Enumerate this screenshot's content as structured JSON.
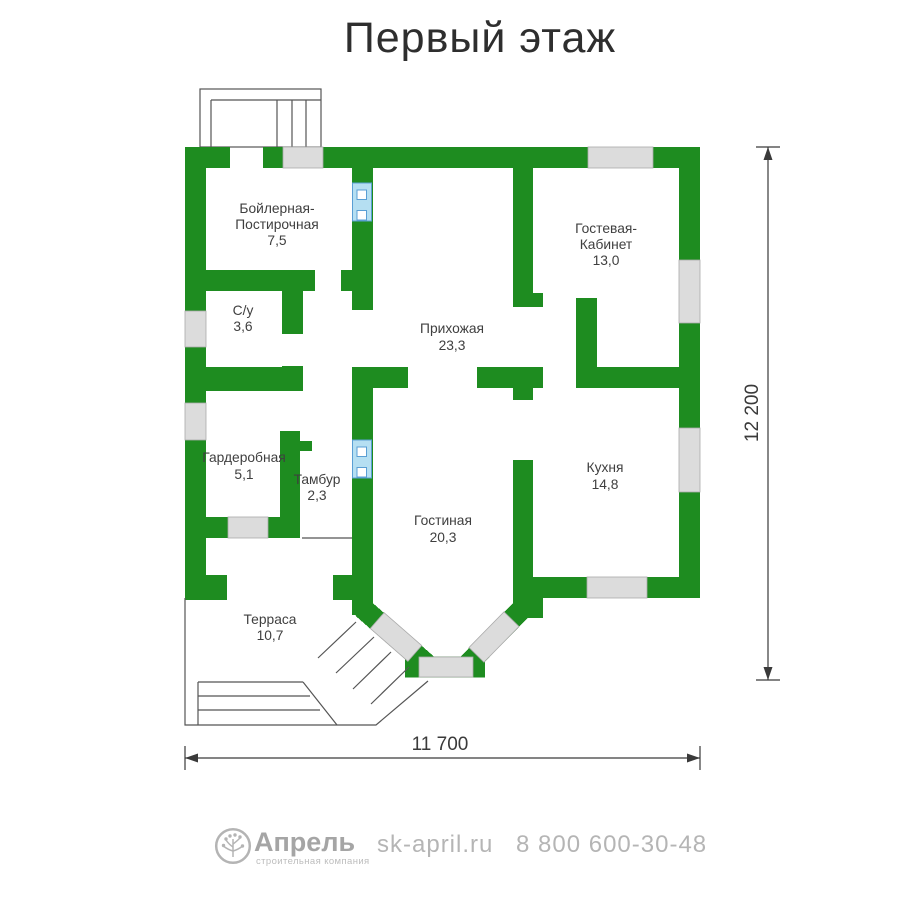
{
  "title": "Первый этаж",
  "rooms": {
    "boiler": {
      "name1": "Бойлерная-",
      "name2": "Постирочная",
      "area": "7,5"
    },
    "guest": {
      "name1": "Гостевая-",
      "name2": "Кабинет",
      "area": "13,0"
    },
    "wc": {
      "name": "С/у",
      "area": "3,6"
    },
    "hallway": {
      "name": "Прихожая",
      "area": "23,3"
    },
    "wardrobe": {
      "name": "Гардеробная",
      "area": "5,1"
    },
    "vestibule": {
      "name": "Тамбур",
      "area": "2,3"
    },
    "kitchen": {
      "name": "Кухня",
      "area": "14,8"
    },
    "living": {
      "name": "Гостиная",
      "area": "20,3"
    },
    "terrace": {
      "name": "Терраса",
      "area": "10,7"
    }
  },
  "dimensions": {
    "height": "12 200",
    "width": "11 700"
  },
  "footer": {
    "brand": "Апрель",
    "tagline": "строительная компания",
    "website": "sk-april.ru",
    "phone": "8 800 600-30-48"
  },
  "colors": {
    "wall": "#1e8c20",
    "window_fill": "#dcdcdc",
    "door_fill": "#b5dff2",
    "door_stroke": "#5a9fd4",
    "outline": "#555555",
    "dimension": "#3a3a3a",
    "footer_text": "#b3b3b3"
  },
  "icons": {
    "logo": "tree-icon"
  }
}
